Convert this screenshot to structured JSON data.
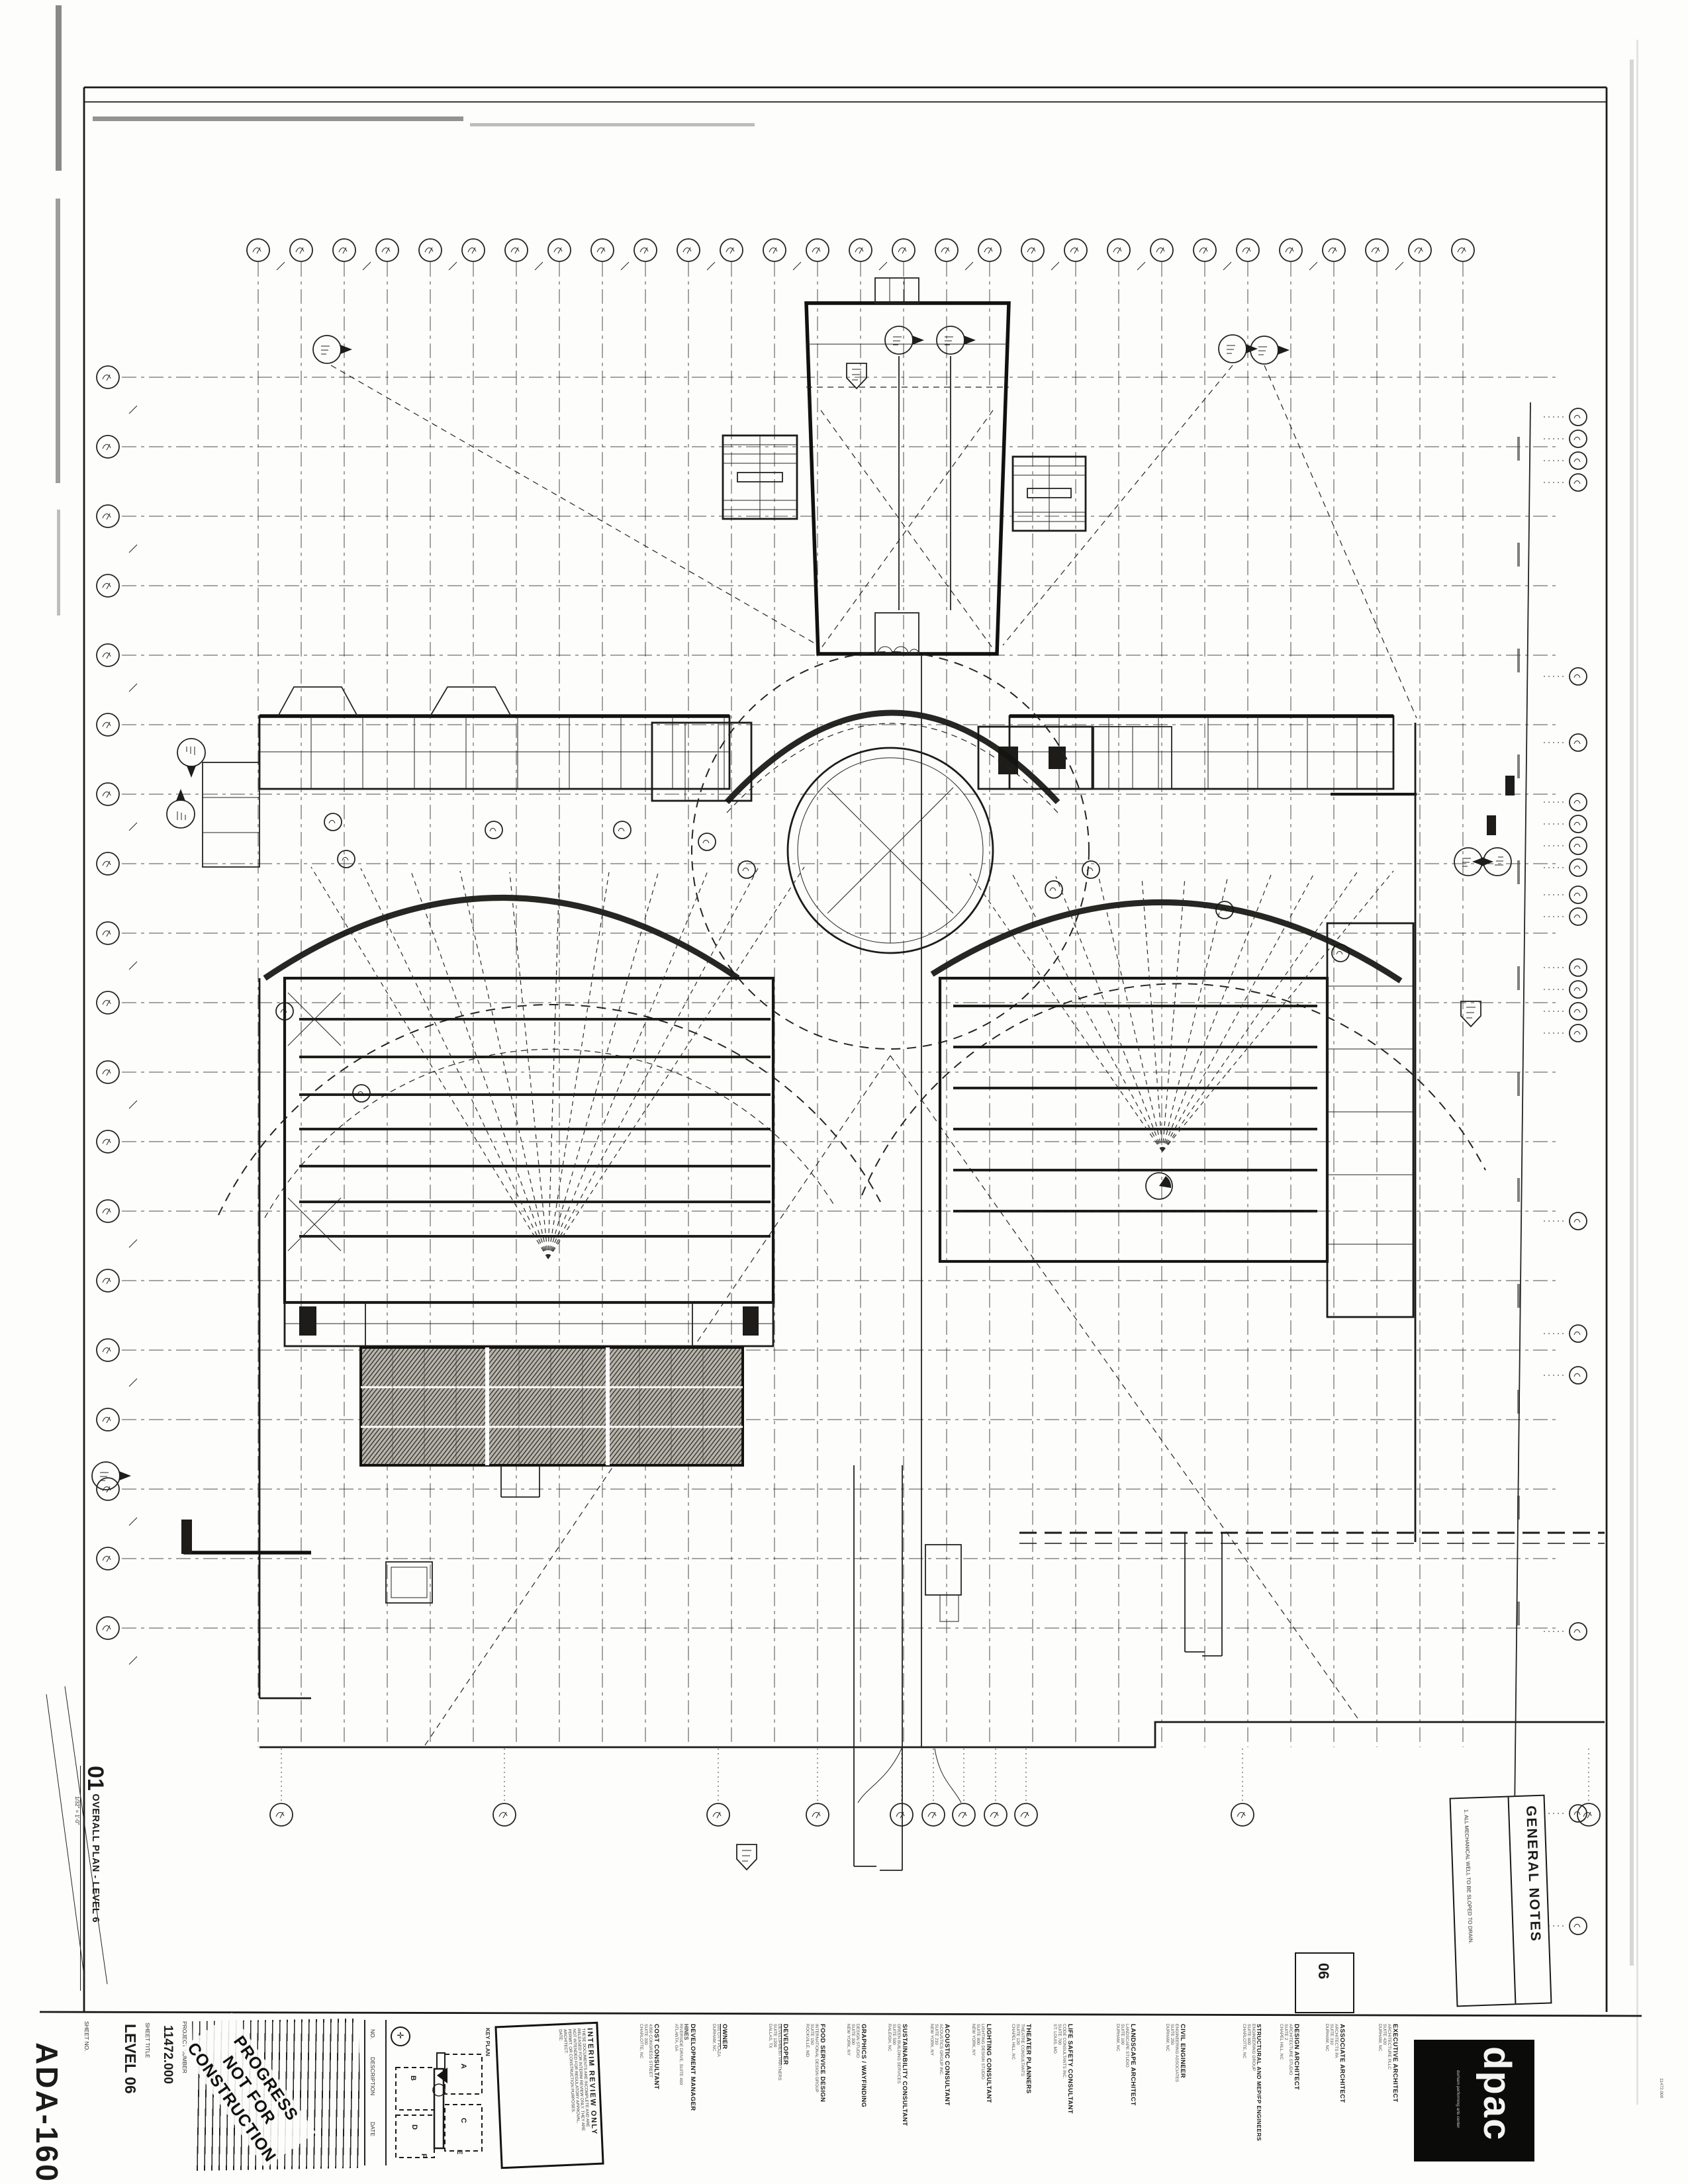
{
  "sheet": {
    "number": "ADA-160",
    "number_label": "SHEET NO.",
    "title": "LEVEL 06",
    "title_label": "SHEET TITLE",
    "project_number": "11472.000",
    "project_number_label": "PROJECT NUMBER"
  },
  "drawing_title": {
    "number": "01",
    "title": "OVERALL PLAN - LEVEL 6",
    "scale": "1/32\" = 1'-0\""
  },
  "progress_stamp": {
    "line1": "PROGRESS",
    "line2": "NOT FOR",
    "line3": "CONSTRUCTION"
  },
  "revision_table": {
    "col1": "NO.",
    "col2": "DESCRIPTION",
    "col3": "DATE"
  },
  "key_plan": {
    "label": "KEY PLAN",
    "a": "A",
    "b": "B",
    "c": "C",
    "d": "D",
    "e": "E",
    "f": "F"
  },
  "interim_stamp": {
    "title": "INTERIM REVIEW ONLY",
    "l1": "THESE DOCUMENTS ARE INCOMPLETE AND ARE",
    "l2": "RELEASED FOR INTERIM REVIEW ONLY. THEY ARE",
    "l3": "NOT INTENDED FOR REGULATORY APPROVAL,",
    "l4": "PERMIT, OR CONSTRUCTION PURPOSES.",
    "l5": "ARCHITECT:",
    "l6": "DATE:"
  },
  "general_notes": {
    "title": "GENERAL NOTES",
    "note1": "1. ALL MECHANICAL WELL TO BE SLOPED TO DRAIN."
  },
  "area_tag": "06",
  "plot_stamp": "11472.000",
  "logo": {
    "name": "dpac",
    "tagline": "durham performing arts center"
  },
  "consultants": [
    {
      "role": "COST CONSULTANT",
      "l1": "4350 CONGRESS STREET",
      "l2": "SUITE 200",
      "l3": "CHARLOTTE, NC"
    },
    {
      "role": "DEVELOPMENT MANAGER",
      "l1": "HINES",
      "l2": "RIVERSIDE DRIVE, SUITE 400",
      "l3": "ATLANTA, GA"
    },
    {
      "role": "OWNER",
      "l1": "101 CITY PLAZA",
      "l2": "DURHAM, NC",
      "l3": ""
    },
    {
      "role": "DEVELOPER",
      "l1": "DEVELOPMENT PARTNERS",
      "l2": "SUITE 1200",
      "l3": "DALLAS, TX"
    },
    {
      "role": "FOOD SERVICE DESIGN",
      "l1": "INTERNATIONAL DESIGN GROUP",
      "l2": "SUITE 150",
      "l3": "ROCKVILLE, MD"
    },
    {
      "role": "GRAPHICS / WAYFINDING",
      "l1": "DESIGN STUDIO",
      "l2": "SUITE 300",
      "l3": "NEW YORK, NY"
    },
    {
      "role": "SUSTAINABILITY CONSULTANT",
      "l1": "GREEN BUILDING SERVICES",
      "l2": "SUITE 500",
      "l3": "RALEIGH, NC"
    },
    {
      "role": "ACOUSTIC CONSULTANT",
      "l1": "ACOUSTICS GROUP INC.",
      "l2": "SUITE 210",
      "l3": "NEW YORK, NY"
    },
    {
      "role": "LIGHTING CONSULTANT",
      "l1": "LIGHTING DESIGN STUDIO",
      "l2": "SUITE 800",
      "l3": "NEW YORK, NY"
    },
    {
      "role": "THEATER PLANNERS",
      "l1": "THEATRE CONSULTANTS",
      "l2": "SUITE 120",
      "l3": "CHAPEL HILL, NC"
    },
    {
      "role": "LIFE SAFETY CONSULTANT",
      "l1": "CODE CONSULTANTS INC.",
      "l2": "SUITE 700",
      "l3": "ST. LOUIS, MO"
    },
    {
      "role": "LANDSCAPE ARCHITECT",
      "l1": "LANDSCAPE STUDIO",
      "l2": "SUITE 100",
      "l3": "DURHAM, NC"
    },
    {
      "role": "CIVIL ENGINEER",
      "l1": "ENGINEERING ASSOCIATES",
      "l2": "SUITE 250",
      "l3": "DURHAM, NC"
    },
    {
      "role": "STRUCTURAL AND MEP/FP ENGINEERS",
      "l1": "ENGINEERING GROUP",
      "l2": "SUITE 600",
      "l3": "CHARLOTTE, NC"
    },
    {
      "role": "DESIGN ARCHITECT",
      "l1": "ARCHITECTURE STUDIO",
      "l2": "SUITE 2",
      "l3": "CHAPEL HILL, NC"
    },
    {
      "role": "ASSOCIATE ARCHITECT",
      "l1": "ARCHITECTS PA",
      "l2": "SUITE 310",
      "l3": "DURHAM, NC"
    },
    {
      "role": "EXECUTIVE ARCHITECT",
      "l1": "ARCHITECTURE PLLC",
      "l2": "SUITE 420",
      "l3": "DURHAM, NC"
    }
  ]
}
